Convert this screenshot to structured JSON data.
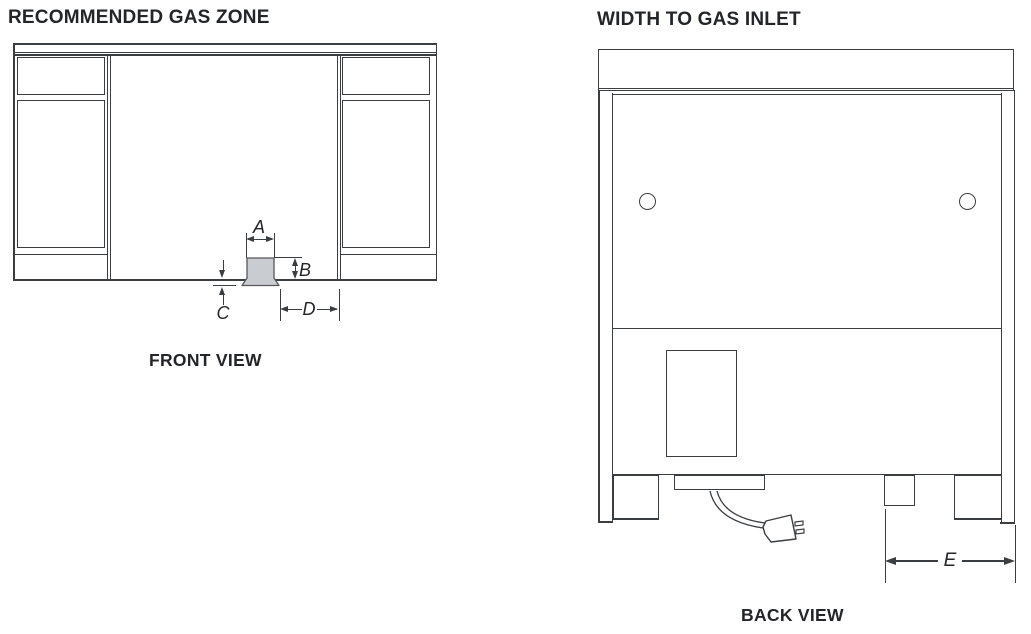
{
  "colors": {
    "background": "#ffffff",
    "line": "#3b3e41",
    "line_strong": "#2e3133",
    "text": "#232528",
    "inlet_fill": "#c9cdd1",
    "inlet_stroke": "#54585c"
  },
  "front_view": {
    "title": "RECOMMENDED GAS ZONE",
    "caption": "FRONT VIEW",
    "labels": {
      "a": "A",
      "b": "B",
      "c": "C",
      "d": "D"
    }
  },
  "back_view": {
    "title": "WIDTH TO GAS INLET",
    "caption": "BACK VIEW",
    "labels": {
      "e": "E"
    }
  }
}
